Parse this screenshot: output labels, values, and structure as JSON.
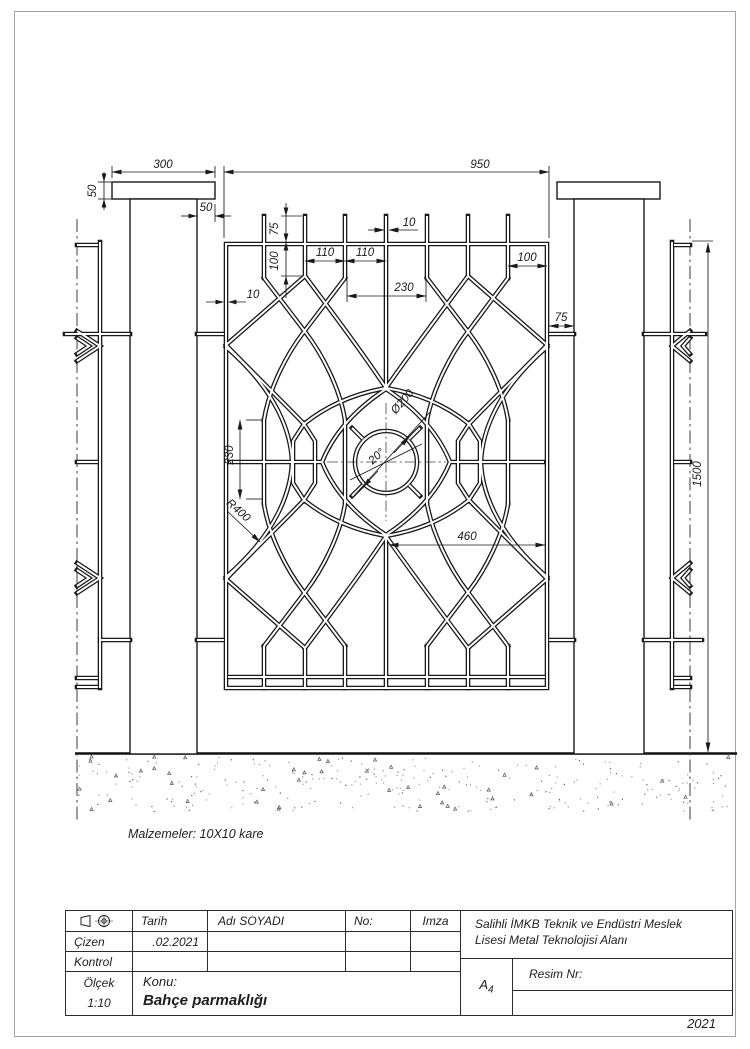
{
  "colors": {
    "line": "#1a1a1a",
    "page_border": "#a0a4a8"
  },
  "dims": {
    "cap_width": "300",
    "panel_width": "950",
    "cap_height": "50",
    "post_edge_offset": "50",
    "spike_height": "75",
    "bar_stub_length": "100",
    "bar_gap_a": "110",
    "bar_gap_b": "110",
    "bar_width": "10",
    "frame_tube_width": "10",
    "edge_margin": "100",
    "center_span": "230",
    "post_panel_gap": "75",
    "mid_segment_length": "230",
    "arc_radius": "R400",
    "circle_diameter": "Ø200",
    "spoke_angle": "20°",
    "half_panel_span": "460",
    "fence_height": "1500"
  },
  "notes": {
    "materials": "Malzemeler: 10X10 kare"
  },
  "title_block": {
    "labels": {
      "tarih": "Tarih",
      "cizen": "Çizen",
      "kontrol": "Kontrol",
      "olcek": "Ölçek",
      "adi_soyadi": "Adı SOYADI",
      "no": "No:",
      "imza": "Imza",
      "konu": "Konu:",
      "resim_nr": "Resim Nr:"
    },
    "values": {
      "scale": "1:10",
      "date": ".02.2021",
      "subject": "Bahçe parmaklığı",
      "school_line1": "Salihli İMKB Teknik ve Endüstri Meslek",
      "school_line2": "Lisesi Metal Teknolojisi Alanı",
      "paper_size": "A",
      "paper_size_sub": "4",
      "year": "2021"
    }
  }
}
